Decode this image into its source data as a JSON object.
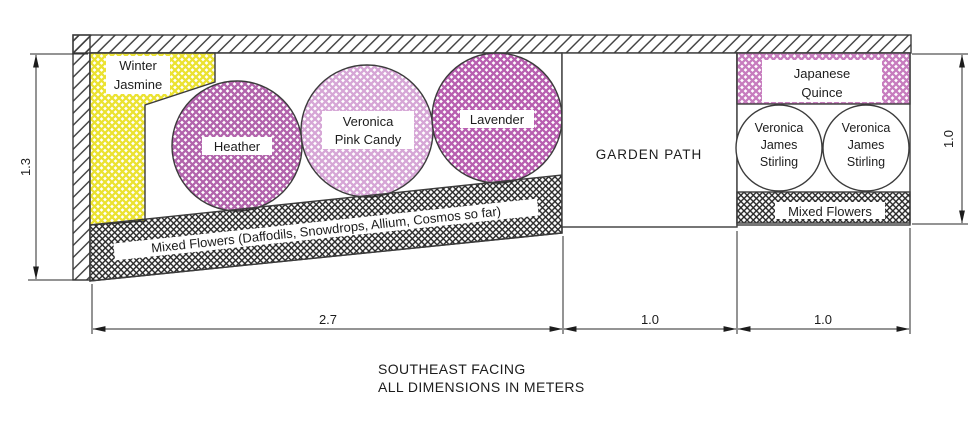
{
  "drawing": {
    "type": "garden-plan",
    "notes": {
      "line1": "SOUTHEAST FACING",
      "line2": "ALL DIMENSIONS IN METERS"
    }
  },
  "plants": {
    "winter_jasmine": {
      "lines": [
        "Winter",
        "Jasmine"
      ]
    },
    "heather": {
      "label": "Heather"
    },
    "veronica_pink_candy": {
      "lines": [
        "Veronica",
        "Pink Candy"
      ]
    },
    "lavender": {
      "label": "Lavender"
    },
    "japanese_quince": {
      "lines": [
        "Japanese",
        "Quince"
      ]
    },
    "veronica_james_stirling_1": {
      "lines": [
        "Veronica",
        "James",
        "Stirling"
      ]
    },
    "veronica_james_stirling_2": {
      "lines": [
        "Veronica",
        "James",
        "Stirling"
      ]
    },
    "mixed_flowers_right": {
      "label": "Mixed Flowers"
    },
    "mixed_flowers_strip": {
      "label": "Mixed Flowers (Daffodils, Snowdrops, Allium, Cosmos so far)"
    }
  },
  "areas": {
    "garden_path": {
      "label": "GARDEN PATH"
    }
  },
  "dimensions": {
    "left_height_m": "1.3",
    "left_bed_width_m": "2.7",
    "path_width_m": "1.0",
    "right_bed_width_m": "1.0",
    "right_bed_height_m": "1.0"
  },
  "colors": {
    "winter_jasmine_hatch": "#ebe231",
    "heather_hatch": "#b264ac",
    "veronica_pink_candy_hatch": "#d6a6d6",
    "lavender_hatch": "#b85fb0",
    "japanese_quince_hatch": "#c77cbe",
    "mixed_flowers_hatch": "#252525",
    "wall_hatch": "#3c3c3c",
    "outline": "#3c3c3c",
    "text": "#1c1c1c"
  }
}
